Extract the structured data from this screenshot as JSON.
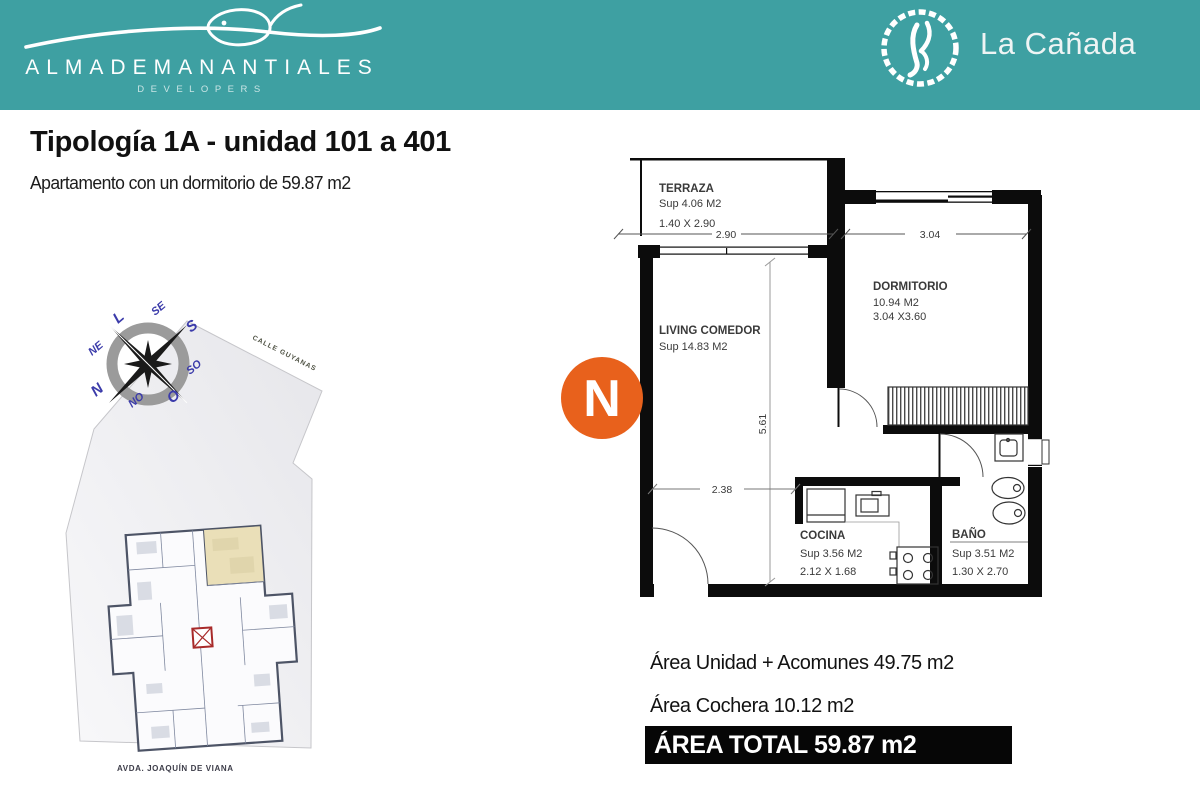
{
  "header": {
    "brand": "ALMADEMANANTIALES",
    "brand_sub": "DEVELOPERS",
    "project": "La Cañada"
  },
  "title": "Tipología 1A - unidad 101 a 401",
  "subtitle": "Apartamento con un dormitorio de 59.87 m2",
  "site": {
    "street_top": "CALLE GUYANAS",
    "street_bottom": "AVDA. JOAQUÍN DE VIANA",
    "compass": {
      "labels": [
        "L",
        "SE",
        "S",
        "NE",
        "SO",
        "N",
        "NO",
        "O"
      ]
    }
  },
  "floorplan": {
    "north_badge": "N",
    "rooms": [
      {
        "name": "TERRAZA",
        "line1": "Sup  4.06 M2",
        "line2": "1.40 X 2.90"
      },
      {
        "name": "DORMITORIO",
        "line1": "10.94 M2",
        "line2": "3.04 X3.60"
      },
      {
        "name": "LIVING COMEDOR",
        "line1": "Sup  14.83 M2",
        "line2": ""
      },
      {
        "name": "COCINA",
        "line1": "Sup  3.56 M2",
        "line2": "2.12 X 1.68"
      },
      {
        "name": "BAÑO",
        "line1": "Sup  3.51 M2",
        "line2": "1.30 X 2.70"
      }
    ],
    "dims": {
      "terraza_width": "2.90",
      "dormitorio_width": "3.04",
      "living_height": "5.61",
      "living_width": "2.38"
    }
  },
  "areas": {
    "unit": "Área Unidad + Acomunes 49.75  m2",
    "garage": "Área  Cochera 10.12 m2",
    "total": "ÁREA TOTAL 59.87 m2"
  },
  "colors": {
    "teal": "#3EA0A2",
    "orange": "#E8611C",
    "wall_black": "#0c0c0c",
    "unit_highlight": "#EADFB8",
    "elevator_red": "#A82A2A",
    "compass_blue": "#3B3BAA"
  }
}
